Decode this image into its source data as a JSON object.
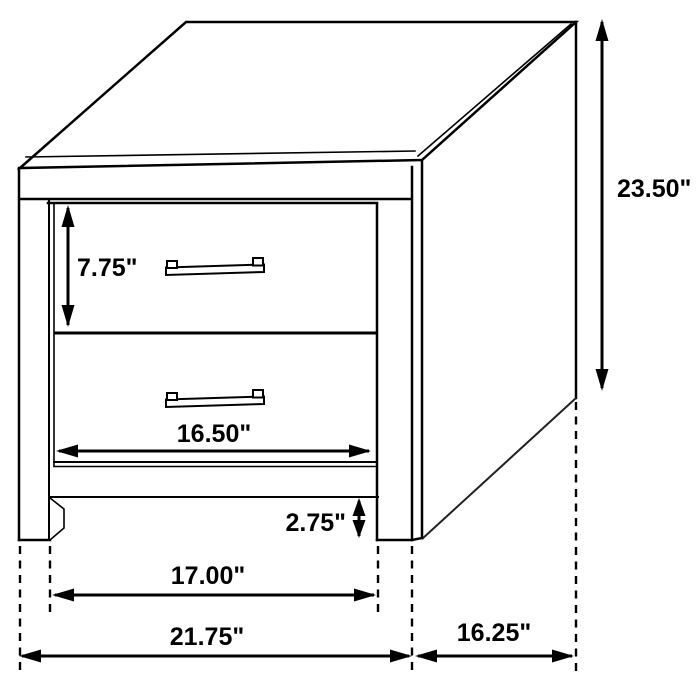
{
  "diagram": {
    "type": "furniture-dimension-diagram",
    "subject": "two-drawer nightstand",
    "units": "inches",
    "dimensions": {
      "drawer_height": {
        "label": "7.75\"",
        "value": 7.75
      },
      "overall_height": {
        "label": "23.50\"",
        "value": 23.5
      },
      "drawer_width": {
        "label": "16.50\"",
        "value": 16.5
      },
      "floor_clearance": {
        "label": "2.75\"",
        "value": 2.75
      },
      "leg_span": {
        "label": "17.00\"",
        "value": 17.0
      },
      "overall_width": {
        "label": "21.75\"",
        "value": 21.75
      },
      "depth": {
        "label": "16.25\"",
        "value": 16.25
      }
    }
  }
}
